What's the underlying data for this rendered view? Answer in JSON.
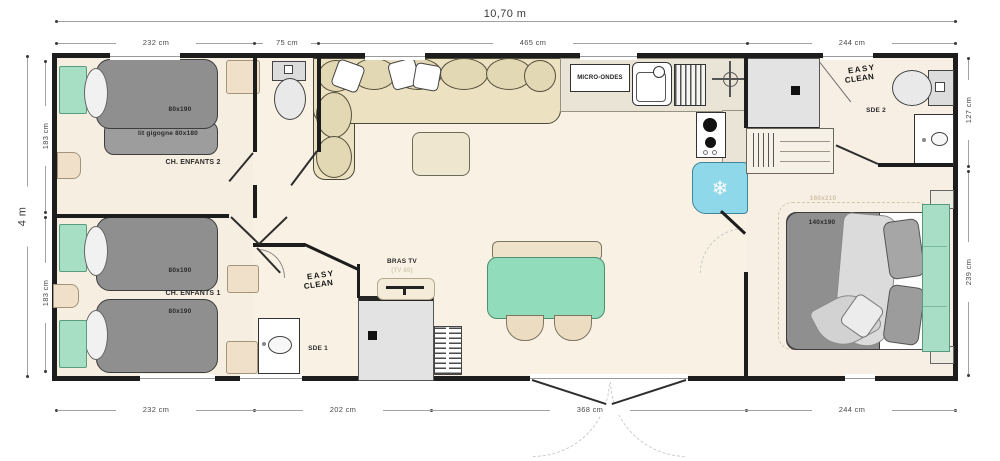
{
  "dims": {
    "overall_width": "10,70 m",
    "overall_height": "4 m",
    "top": [
      "232 cm",
      "75 cm",
      "465 cm",
      "244 cm"
    ],
    "bottom": [
      "232 cm",
      "202 cm",
      "368 cm",
      "244 cm"
    ],
    "left": [
      "183 cm",
      "183 cm"
    ],
    "right": [
      "127 cm",
      "239 cm"
    ]
  },
  "rooms": {
    "bedroom2": {
      "name": "CH. ENFANTS 2",
      "bed": "80x190",
      "trundle": "lit gigogne 80x180"
    },
    "bedroom1": {
      "name": "CH. ENFANTS 1",
      "bed_top": "80x190",
      "bed_bottom": "80x190"
    },
    "sde1": {
      "name": "SDE 1"
    },
    "sde2": {
      "name": "SDE 2"
    },
    "master": {
      "bed": "140x190",
      "clearance": "160x210"
    },
    "kitchen": {
      "microwave": "MICRO-ONDES"
    }
  },
  "tv": {
    "label": "BRAS TV",
    "sub": "(TV 80)"
  },
  "brand": {
    "line1": "EASY",
    "line2": "CLEAN"
  },
  "icons": {
    "snowflake": "❄"
  },
  "colors": {
    "wall": "#1d1d1d",
    "floor": "#f8f0e3",
    "accent_green": "#a6dfc4",
    "fridge_cyan": "#8ed8ea"
  }
}
